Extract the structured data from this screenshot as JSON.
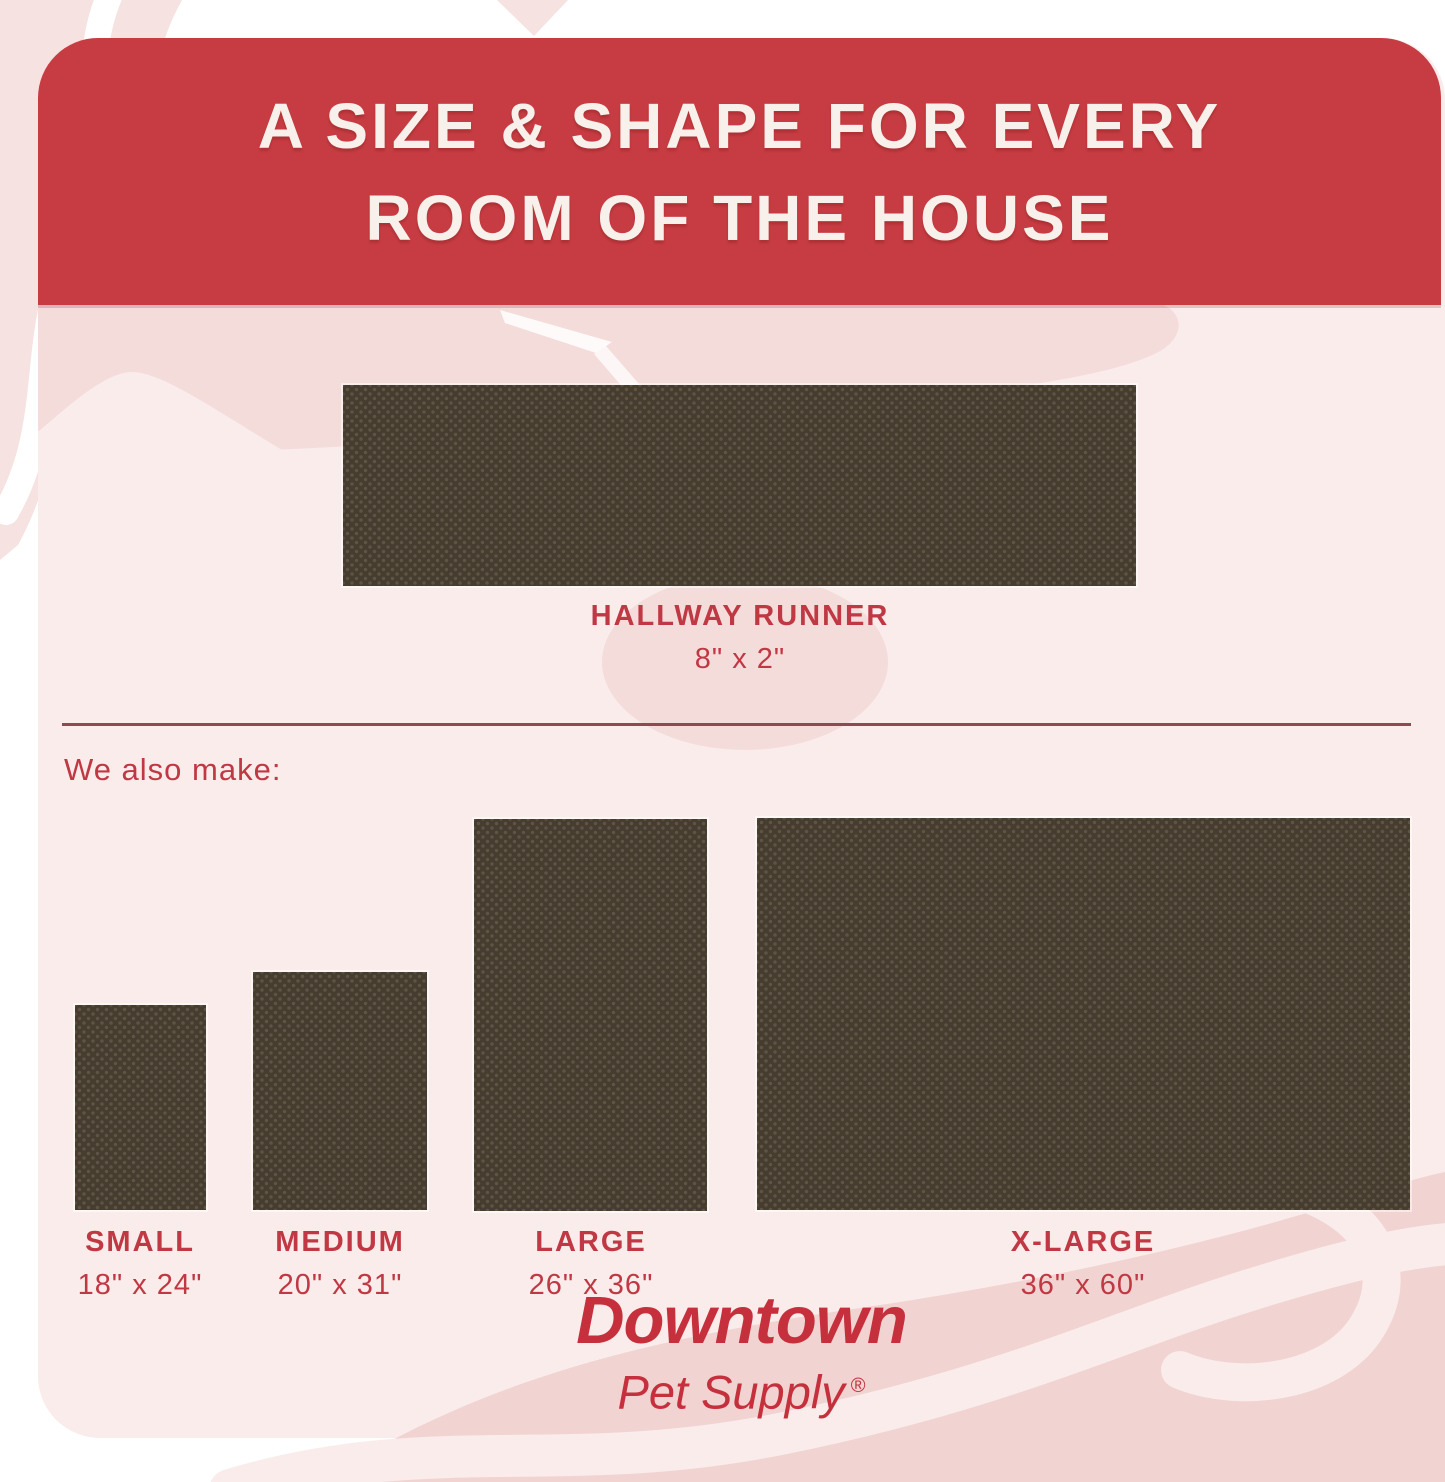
{
  "header": {
    "title_line1": "A SIZE & SHAPE FOR EVERY",
    "title_line2": "ROOM OF THE HOUSE"
  },
  "featured": {
    "name": "HALLWAY RUNNER",
    "dimensions": "8\" x 2\""
  },
  "note": "We also make:",
  "products": [
    {
      "name": "SMALL",
      "dimensions": "18\" x 24\""
    },
    {
      "name": "MEDIUM",
      "dimensions": "20\" x 31\""
    },
    {
      "name": "LARGE",
      "dimensions": "26\" x 36\""
    },
    {
      "name": "X-LARGE",
      "dimensions": "36\" x 60\""
    }
  ],
  "brand": {
    "name": "Downtown",
    "sub": "Pet Supply",
    "registered": "®"
  },
  "colors": {
    "banner_red": "#C63C42",
    "label_red": "#C03843",
    "logo_red": "#C5303C",
    "divider_maroon": "#8E4A52",
    "mat_brown": "#463D30",
    "panel_pink": "#F9ECEB",
    "blob_pink": "#F4DCDB",
    "outer_pink": "#F5E2E1",
    "swoosh_pink": "#F1D3D2",
    "title_offwhite": "#F7F0EB"
  }
}
